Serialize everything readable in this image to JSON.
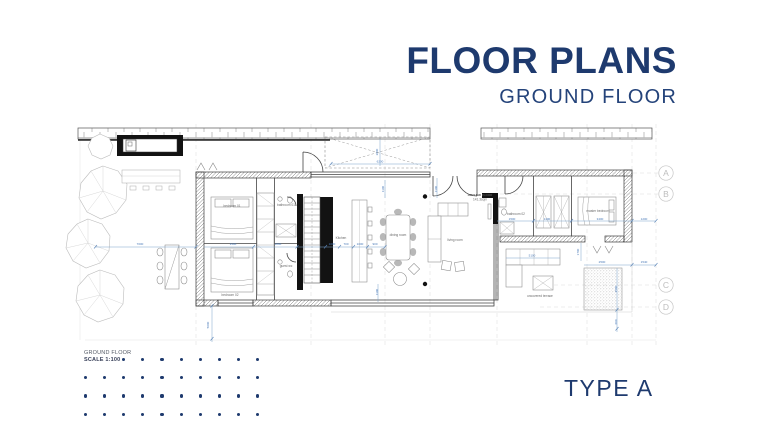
{
  "header": {
    "title": "FLOOR PLANS",
    "subtitle": "GROUND FLOOR"
  },
  "footer": {
    "type_label": "TYPE A",
    "scale_line1": "GROUND FLOOR",
    "scale_line2": "SCALE 1:100"
  },
  "plan": {
    "room_labels": [
      {
        "t": "bedroom 01",
        "x": 232,
        "y": 207
      },
      {
        "t": "bedroom 02",
        "x": 230,
        "y": 296
      },
      {
        "t": "bathroom 01",
        "x": 286,
        "y": 206
      },
      {
        "t": "guest wc",
        "x": 286,
        "y": 267
      },
      {
        "t": "Kitchen",
        "x": 341,
        "y": 239
      },
      {
        "t": "dining room",
        "x": 398,
        "y": 236
      },
      {
        "t": "living room",
        "x": 455,
        "y": 241
      },
      {
        "t": "GROUND FLOOR",
        "x": 480,
        "y": 196,
        "b": 1
      },
      {
        "t": "141.3sqm",
        "x": 480,
        "y": 200.5
      },
      {
        "t": "bathroom 02",
        "x": 516,
        "y": 215
      },
      {
        "t": "master bedroom",
        "x": 598,
        "y": 212
      },
      {
        "t": "uncovered terrace",
        "x": 540,
        "y": 297
      }
    ],
    "dimensions": [
      {
        "t": "7000",
        "x": 140,
        "y": 245
      },
      {
        "t": "2000",
        "x": 378,
        "y": 152,
        "r": -90
      },
      {
        "t": "6200",
        "x": 380,
        "y": 162.5
      },
      {
        "t": "1100",
        "x": 384,
        "y": 189,
        "r": -90
      },
      {
        "t": "1100",
        "x": 437,
        "y": 189,
        "r": -90
      },
      {
        "t": "1100",
        "x": 378,
        "y": 292,
        "r": -90
      },
      {
        "t": "1500",
        "x": 233,
        "y": 245
      },
      {
        "t": "1800",
        "x": 278,
        "y": 245
      },
      {
        "t": "1000",
        "x": 332,
        "y": 245
      },
      {
        "t": "700",
        "x": 346,
        "y": 245
      },
      {
        "t": "1000",
        "x": 360,
        "y": 245
      },
      {
        "t": "900",
        "x": 375,
        "y": 245
      },
      {
        "t": "1500",
        "x": 512,
        "y": 220
      },
      {
        "t": "1100",
        "x": 547,
        "y": 220
      },
      {
        "t": "3400",
        "x": 600,
        "y": 220
      },
      {
        "t": "1200",
        "x": 644,
        "y": 220
      },
      {
        "t": "5000",
        "x": 209,
        "y": 325,
        "r": -90
      },
      {
        "t": "5100",
        "x": 532,
        "y": 256.5
      },
      {
        "t": "1700",
        "x": 579,
        "y": 252,
        "r": -90
      },
      {
        "t": "2500",
        "x": 602,
        "y": 263
      },
      {
        "t": "1540",
        "x": 644,
        "y": 263
      },
      {
        "t": "2500",
        "x": 617,
        "y": 289,
        "r": -90
      },
      {
        "t": "600",
        "x": 617,
        "y": 322,
        "r": -90
      }
    ],
    "grid_bubbles": [
      {
        "t": "A",
        "y": 173
      },
      {
        "t": "B",
        "y": 194
      },
      {
        "t": "C",
        "y": 285
      },
      {
        "t": "D",
        "y": 307
      }
    ]
  },
  "decor": {
    "dot_grid": {
      "rows": 4,
      "cols": 10,
      "first_row_skip": 2
    }
  },
  "colors": {
    "navy": "#1e3a6e",
    "dim_blue": "#4a7ab8",
    "plan_gray": "#555555"
  }
}
